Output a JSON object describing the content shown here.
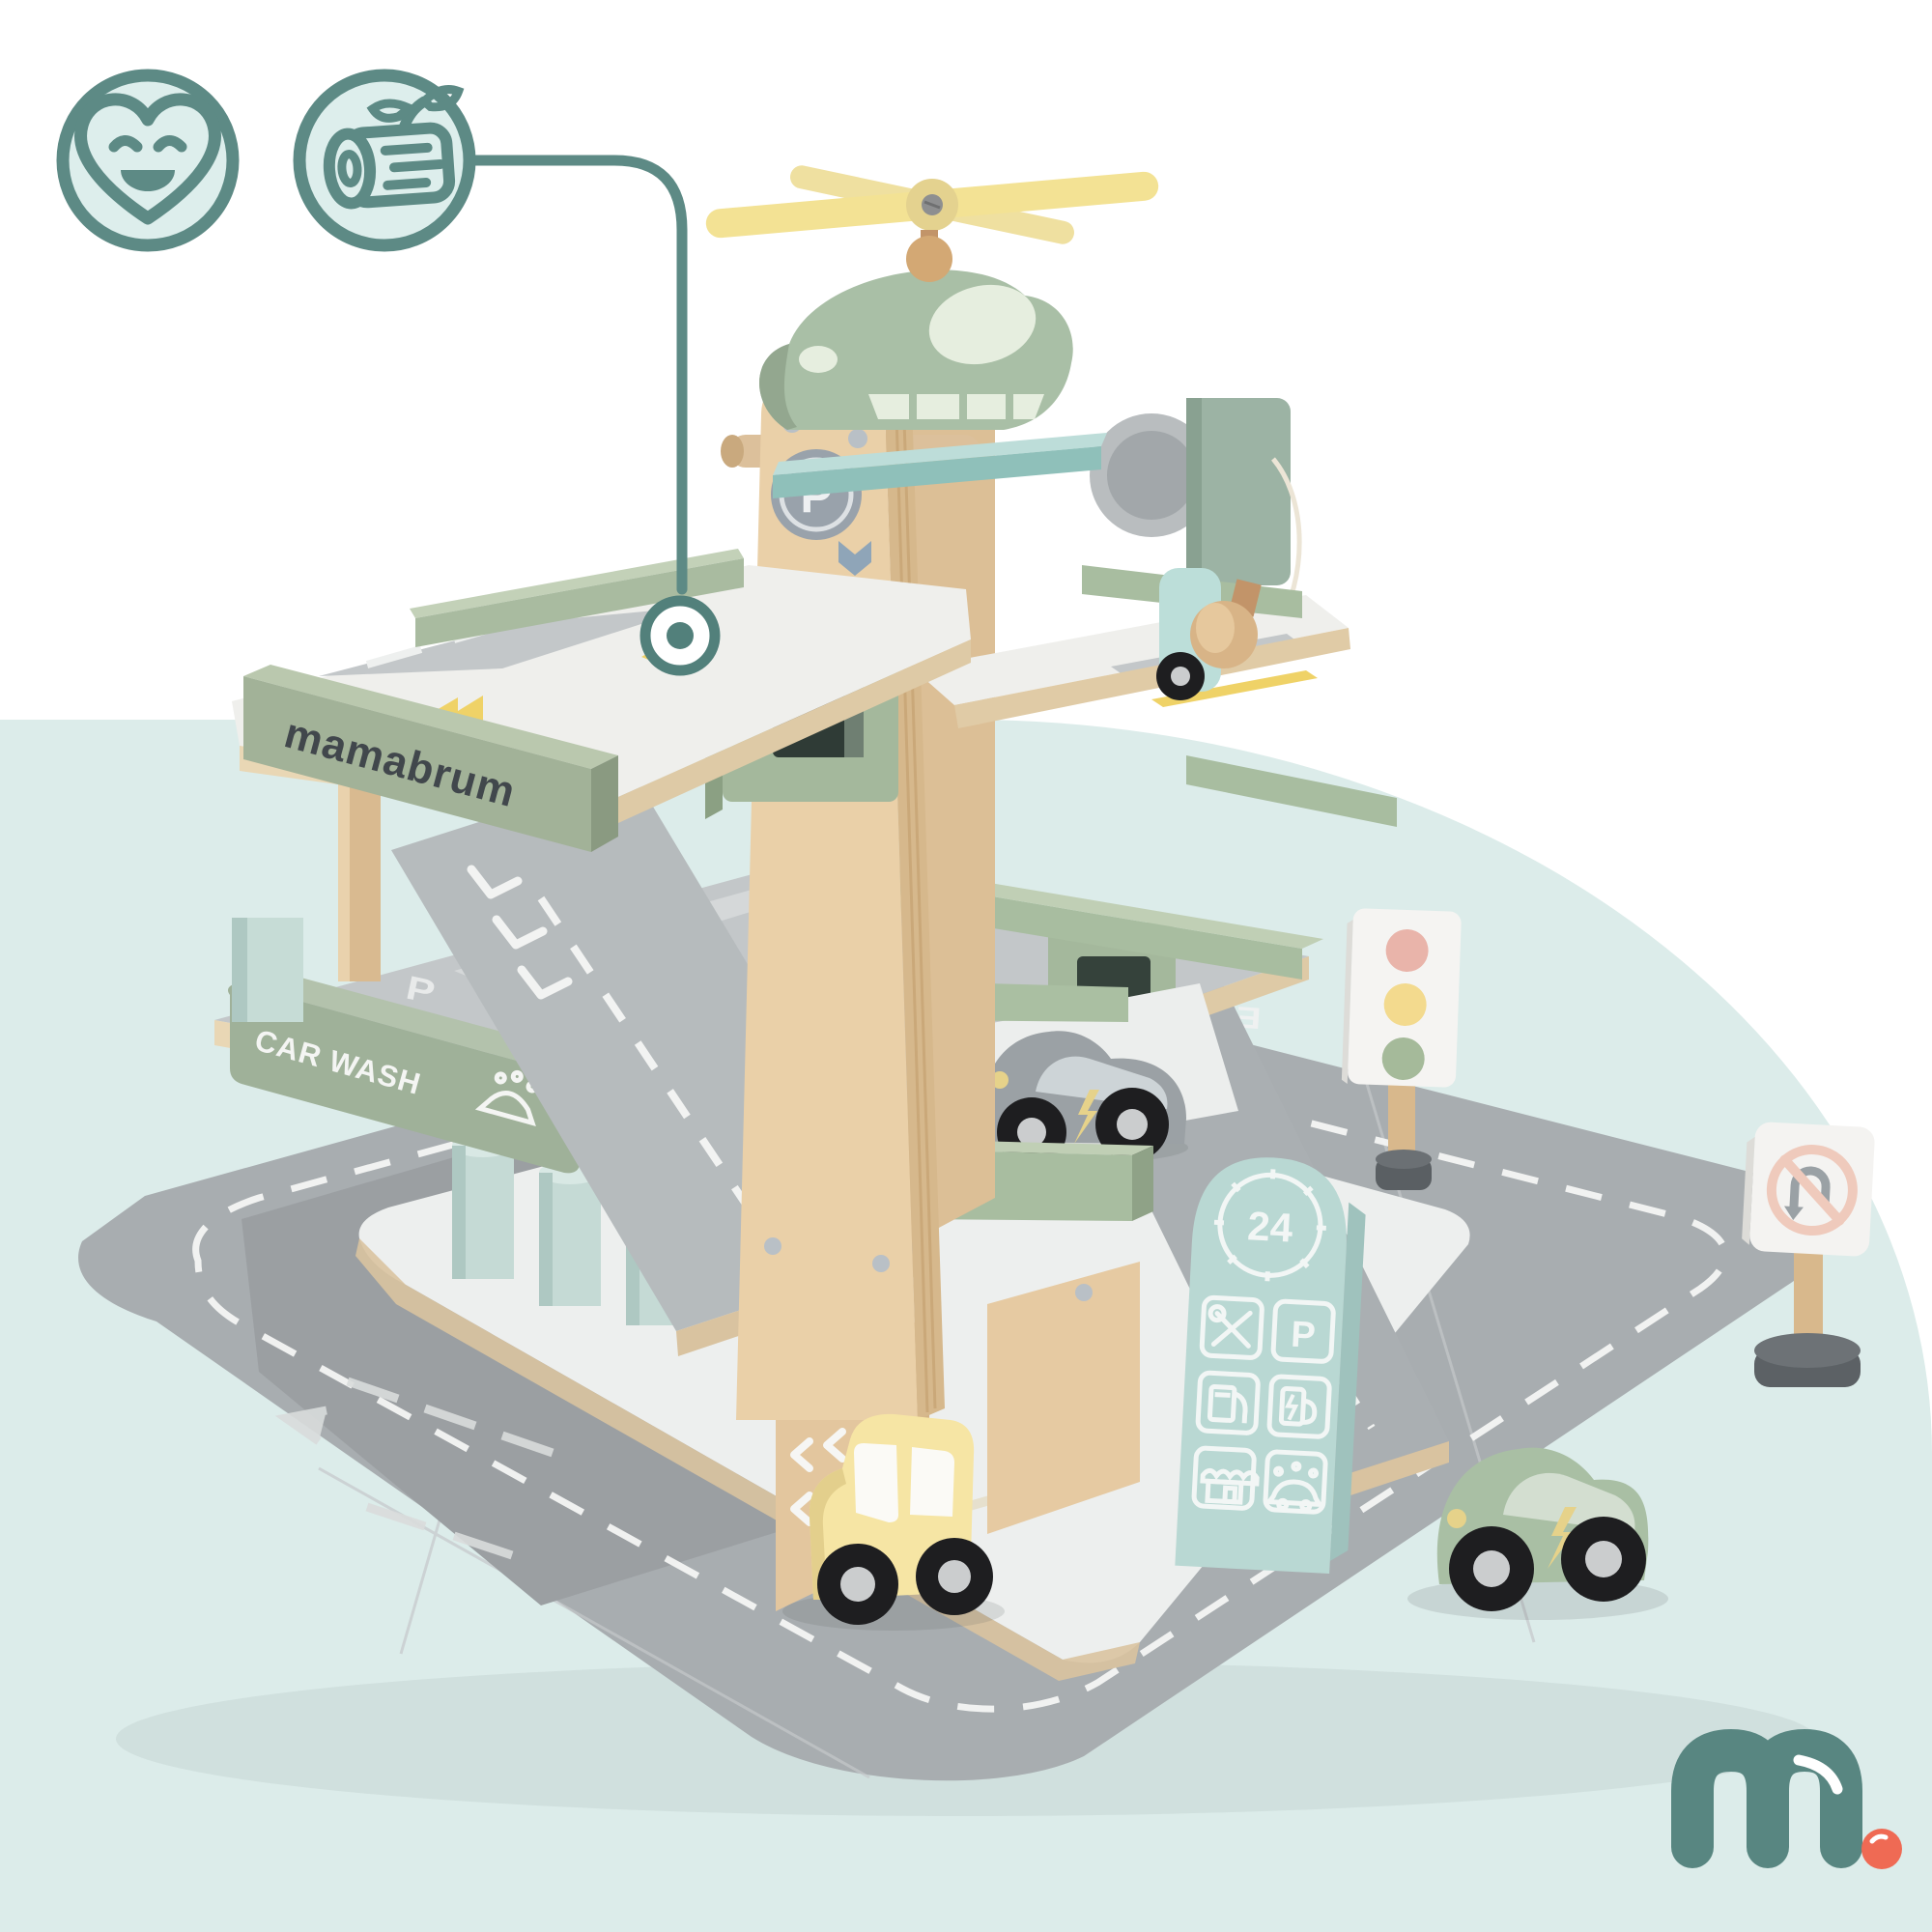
{
  "page": {
    "type": "product-photo",
    "subject": "wooden toy parking garage playset",
    "background_color": "#ffffff",
    "accent_blob_color": "#dcecea"
  },
  "badges": {
    "stroke_color": "#5d8a85",
    "fill_color": "#ddeeec",
    "items": [
      {
        "icon": "smiling-heart-icon"
      },
      {
        "icon": "eco-wood-log-icon"
      }
    ],
    "callout": {
      "icon": "connector-line-ring-icon"
    }
  },
  "toy": {
    "brand_block_label": "mamabrum",
    "car_wash_label": "CAR WASH",
    "service_hours_label": "24",
    "exit_label": "EXIT",
    "parking_sticker_letter": "P",
    "deck_parking_letters": [
      "P",
      "P"
    ],
    "service_board_parking_letter": "P",
    "colors": {
      "plywood": "#ead0a8",
      "sage_green": "#aabfa2",
      "mint_platform": "#b7dad6",
      "deck_gray": "#c3c7c9",
      "mat_gray": "#a8adb0",
      "rotor_yellow": "#f3e294",
      "service_sign_teal": "#b9d8d3",
      "traffic_red": "#e9b4aa",
      "traffic_yellow": "#f3da8e",
      "traffic_green": "#a5ba9a",
      "car_gray": "#9ba1a5",
      "car_green": "#a9bfa4",
      "car_yellow": "#f6e5a4",
      "car_mint": "#bcded9"
    }
  },
  "logo": {
    "text": "m.",
    "color": "#588681",
    "dot_color": "#ef6a54"
  }
}
